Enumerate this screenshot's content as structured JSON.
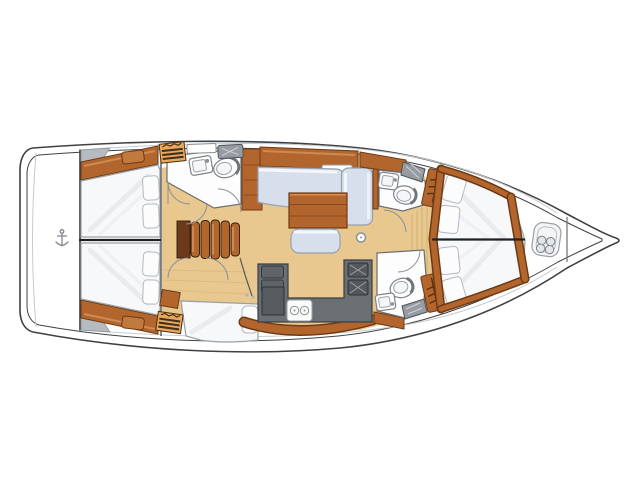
{
  "figure": {
    "kind": "sailboat-interior-floor-plan",
    "view": "top-down",
    "orientation": "bow-right-stern-left"
  },
  "palette": {
    "hull_line": "#3e4144",
    "deck_line": "#c6cbd0",
    "wood": "#b2662e",
    "wood_edge": "#6e3a14",
    "wood_light": "#d2915a",
    "hatch": "#eaa85f",
    "floor": "#e8c88e",
    "floor_line": "#c6a269",
    "sofa": "#d6dfeb",
    "sofa_line": "#97a1ac",
    "counter": "#6a6f73",
    "counter_dark": "#53585c",
    "fixture_line": "#7d838a",
    "locker_gray": "#969ca2",
    "wardrobe": "#565b5f",
    "bed": "#f7f8f9"
  },
  "areas": [
    "swim-platform",
    "port-aft-cabin",
    "starboard-aft-cabin",
    "companionway-steps",
    "aft-head",
    "salon",
    "galley",
    "starboard-mid-cabin",
    "port-forward-head",
    "starboard-forward-head",
    "forward-owner-cabin",
    "anchor-locker"
  ],
  "icons": [
    {
      "name": "anchor-icon",
      "shape": "small gray anchor on swim platform"
    },
    {
      "name": "windlass-icon",
      "shape": "rounded square with four-lobe clover at bow"
    },
    {
      "name": "hanger-icon",
      "shape": "rail with slanted hanger ticks on wardrobe lockers"
    },
    {
      "name": "toilet-icon",
      "shape": "oval bowl with seat rim"
    },
    {
      "name": "sink-icon",
      "shape": "rounded basin with faucet dot"
    },
    {
      "name": "stove-icon",
      "shape": "white top with two burner circles"
    },
    {
      "name": "mast-foot-icon",
      "shape": "small circle on salon floor"
    }
  ]
}
